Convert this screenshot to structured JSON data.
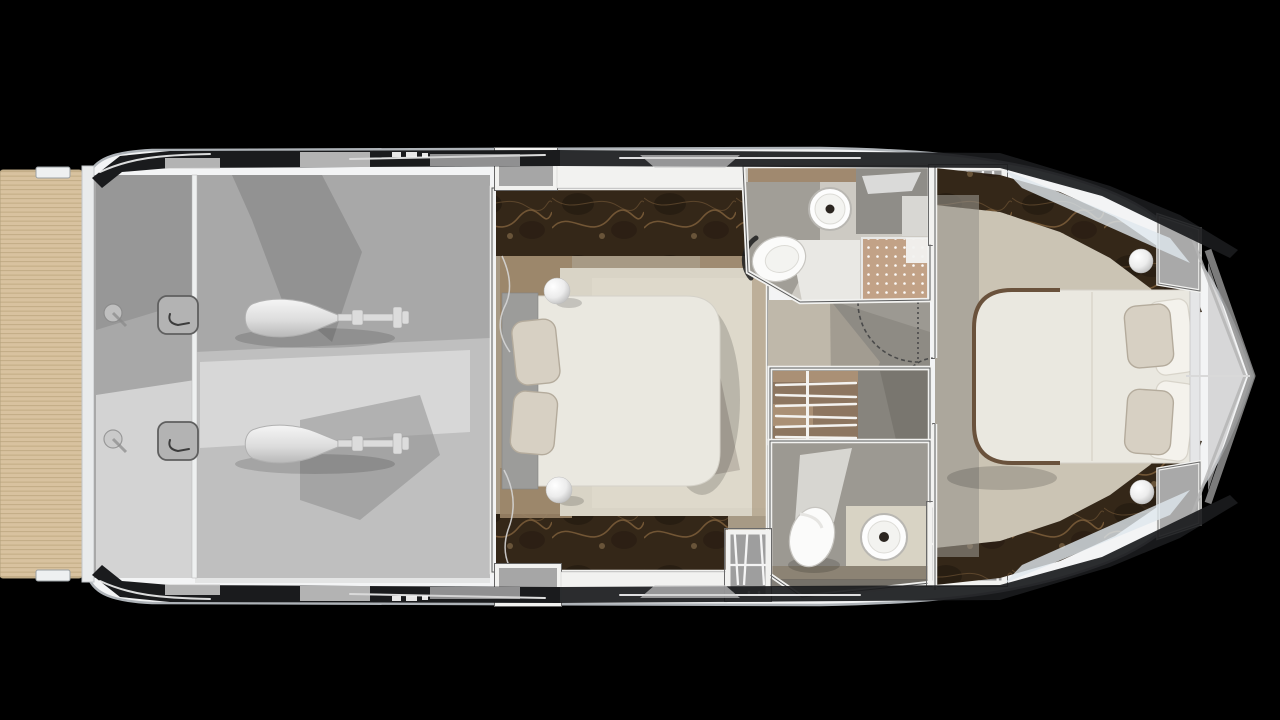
{
  "scene": {
    "type": "yacht-lower-deck-floorplan",
    "view": "top-down-render",
    "areas": [
      "swim-platform",
      "engine-room",
      "mid-cabin",
      "upper-bathroom",
      "lower-bathroom",
      "wardrobe",
      "corridor",
      "forward-cabin",
      "bow-deck"
    ],
    "fixtures": {
      "engines": 2,
      "double-beds": 2,
      "toilets": 2,
      "round-sinks": 2,
      "showers": 1,
      "wardrobe-hangers": 6,
      "sphere-lamps": 4,
      "skylight-hatches": 3,
      "deck-hatches": 4,
      "door-swings": 4
    }
  },
  "palette": {
    "background": "#000000",
    "hull_white": "#f3f4f5",
    "hull_edge": "#aeb3b8",
    "gunwale_dark": "#1a1b1d",
    "teak": "#d8c29f",
    "teak_line": "#c2ab85",
    "deck_grey": "#a8a8a8",
    "deck_light": "#d6d6d6",
    "deck_shadow": "#838383",
    "wall_white": "#f2f2f0",
    "wall_core": "#58595a",
    "marble_brown": "#342718",
    "marble_vein": "#8d6a42",
    "wood_brown": "#9b8568",
    "rug_beige": "#d9d4c6",
    "bed_white": "#eae8e0",
    "pillow_beige": "#d7d0c3",
    "headboard_grey": "#9c9c9a",
    "bath_floor": "#cdcac3",
    "bath_grey": "#9c9992",
    "shower_tile": "#c2a287",
    "wardrobe_wood": "#8d7660",
    "hatch_grey": "#a6a6a6",
    "skylight_grey": "#9e9e9e",
    "fixture_white": "#fbfbfa",
    "drain_dark": "#2b2520",
    "bow_chevron": "#919191",
    "door_arc": "#4a4a4a",
    "glass_tint": "#dfe7ee"
  }
}
